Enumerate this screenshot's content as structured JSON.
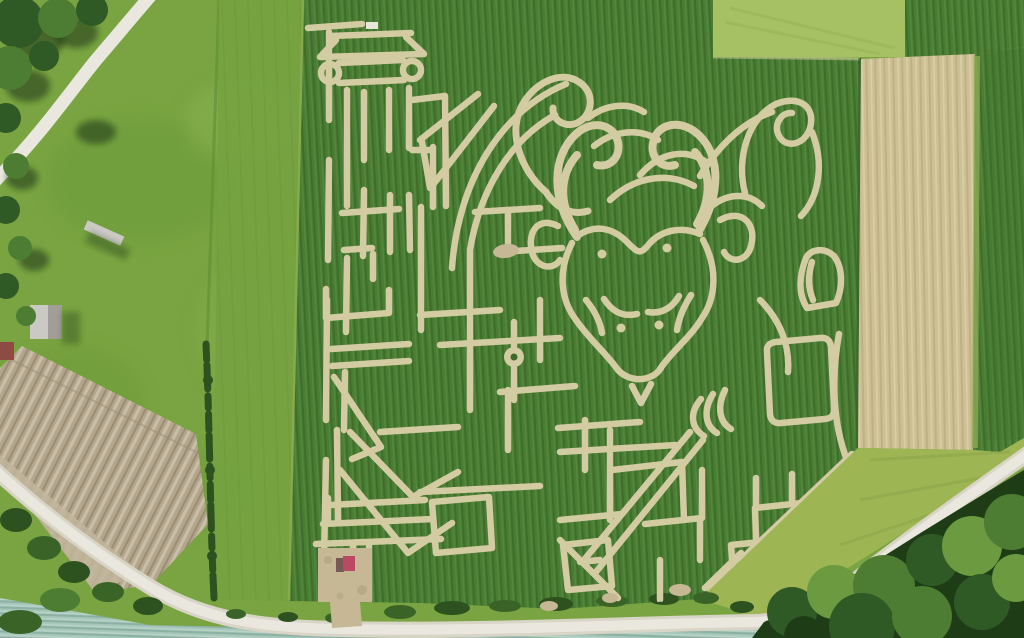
{
  "colors": {
    "base_grass": "#79a441",
    "grass_shade": "#6d9839",
    "grass_light": "#8ab150",
    "mow_strip": "#76a241",
    "corn": "#4a7d34",
    "corn_dark": "#3f6e2b",
    "corn_light": "#568a3e",
    "corn_edge": "#3a652c",
    "patch_tr": "#a6c164",
    "patch_streak": "#96b254",
    "tan_strip": "#cdc094",
    "tan_dark": "#bfb184",
    "tan_light": "#d9cfa6",
    "sliver_green": "#8fae54",
    "mowed_br": "#9db553",
    "mowed_br_streak": "#8aa44a",
    "plow": "#b3a68c",
    "plow_light": "#c9bfa9",
    "plow_dark": "#9b8d74",
    "headland": "#c1b59b",
    "road": "#eae7de",
    "road_edge": "#d8d4c6",
    "teal": "#a7c7bb",
    "teal_dark": "#8bb1a3",
    "teal_light": "#bdd7cb",
    "hedge": "#2e5120",
    "bush": "#3a6327",
    "tree": "#2f5a26",
    "tree_light": "#4d7d33",
    "tree_lighter": "#6b9a40",
    "tree_dark": "#1e3d16",
    "tree_shadow": "rgba(20,40,12,0.55)",
    "maze_path": "#d3cba2",
    "maze_bright": "#e2dbb4",
    "dirt": "#c6b795",
    "dirt_dark": "#b1a07e",
    "red_object": "#b84a63",
    "red_object_dark": "#57303a",
    "boundary": "#5f8e33",
    "building_roof": "#cbc9c3",
    "building_dark": "#8e8c85",
    "building_red": "#8d4b43",
    "white_marker": "#e9e5da",
    "circle_center": "#3c6a2d"
  }
}
